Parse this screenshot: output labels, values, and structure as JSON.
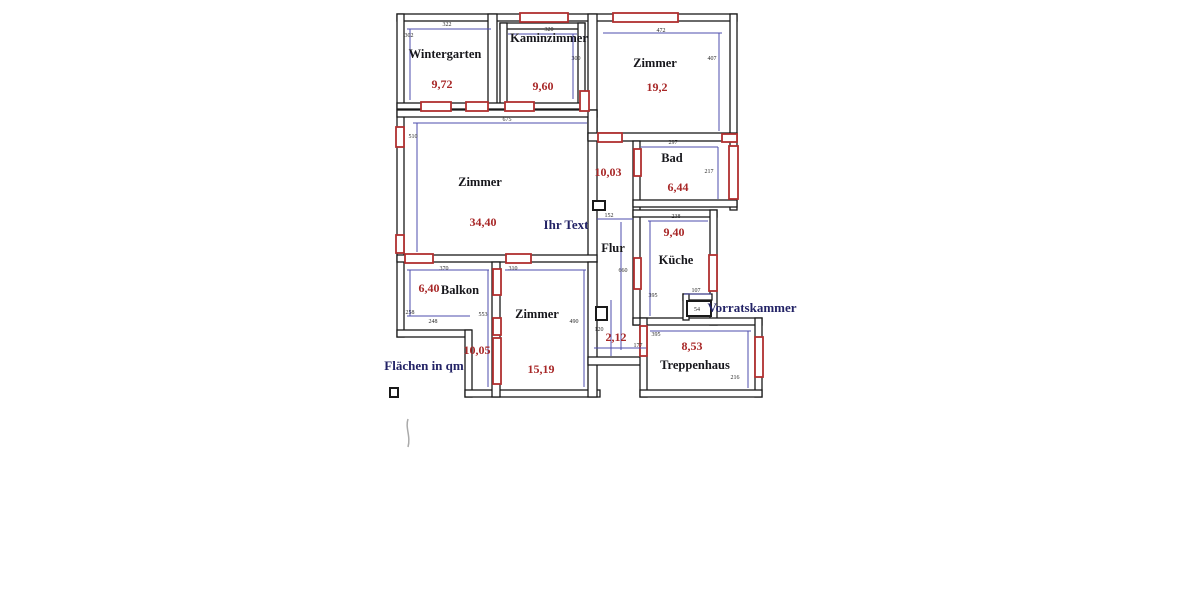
{
  "drawing": {
    "type": "floor-plan",
    "unit_note": "Flächen in qm",
    "placeholder_text": "Ihr Text"
  },
  "colors": {
    "wall": "#1a1a1a",
    "dimension_line": "#4d4dae",
    "door_window_marker": "#b03030",
    "area_text": "#a82828",
    "room_text": "#17171c",
    "note_text": "#232366",
    "background": "#ffffff"
  },
  "rooms": [
    {
      "id": "wintergarten",
      "label": "Wintergarten",
      "area": "9,72"
    },
    {
      "id": "kaminzimmer",
      "label": "Kaminzimmer",
      "area": "9,60"
    },
    {
      "id": "zimmer-nordost",
      "label": "Zimmer",
      "area": "19,2"
    },
    {
      "id": "zimmer-west",
      "label": "Zimmer",
      "area": "34,40"
    },
    {
      "id": "bad",
      "label": "Bad",
      "area": "6,44"
    },
    {
      "id": "flur",
      "label": "Flur",
      "area": "10,03"
    },
    {
      "id": "kueche",
      "label": "Küche",
      "area": "9,40"
    },
    {
      "id": "balkon",
      "label": "Balkon",
      "area": "6,40"
    },
    {
      "id": "zimmer-sued",
      "label": "Zimmer",
      "area": "15,19"
    },
    {
      "id": "treppenhaus",
      "label": "Treppenhaus",
      "area": "8,53"
    },
    {
      "id": "korridor",
      "label": "",
      "area": "2,12"
    },
    {
      "id": "gang",
      "label": "",
      "area": "10,05"
    }
  ],
  "annotations": {
    "vorratskammer": "Vorratskammer"
  },
  "dims": {
    "d322": "322",
    "d302": "302",
    "d320": "320",
    "d300": "300",
    "d472": "472",
    "d407": "407",
    "d675": "675",
    "d510": "510",
    "d297": "297",
    "d217": "217",
    "d152": "152",
    "d238": "238",
    "d660": "660",
    "d395k": "395",
    "d107": "107",
    "d54": "54",
    "d370": "370",
    "d258": "258",
    "d248": "248",
    "d553": "553",
    "d310": "310",
    "d490": "490",
    "d120": "120",
    "d177": "177",
    "d395t": "395",
    "d216": "216"
  }
}
